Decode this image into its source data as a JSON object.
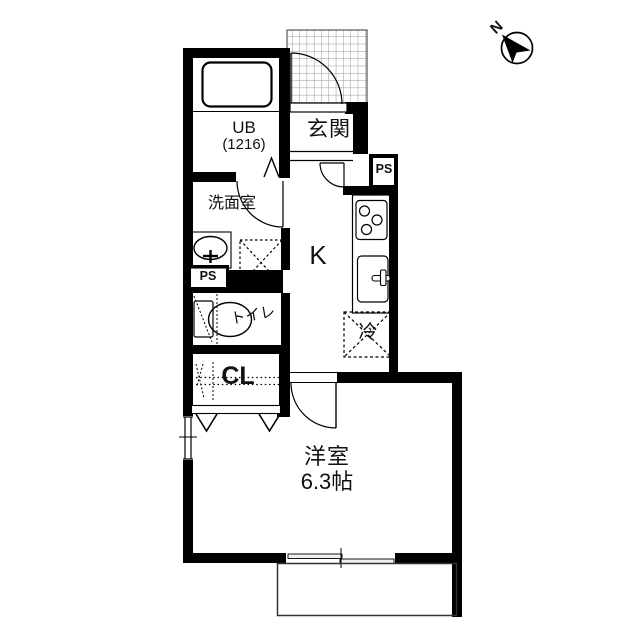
{
  "floorplan": {
    "compass": {
      "north": "N"
    },
    "labels": {
      "entrance": "玄関",
      "unit_bath": "UB",
      "unit_bath_size": "(1216)",
      "washroom": "洗面室",
      "toilet": "トイレ",
      "closet": "CL",
      "kitchen": "K",
      "refrigerator": "冷",
      "western_room": "洋室",
      "western_room_size": "6.3帖",
      "pipe_space_left": "PS",
      "pipe_space_right": "PS"
    },
    "colors": {
      "wall": "#000000",
      "background": "#ffffff",
      "hatch_grid": "#999999"
    }
  }
}
